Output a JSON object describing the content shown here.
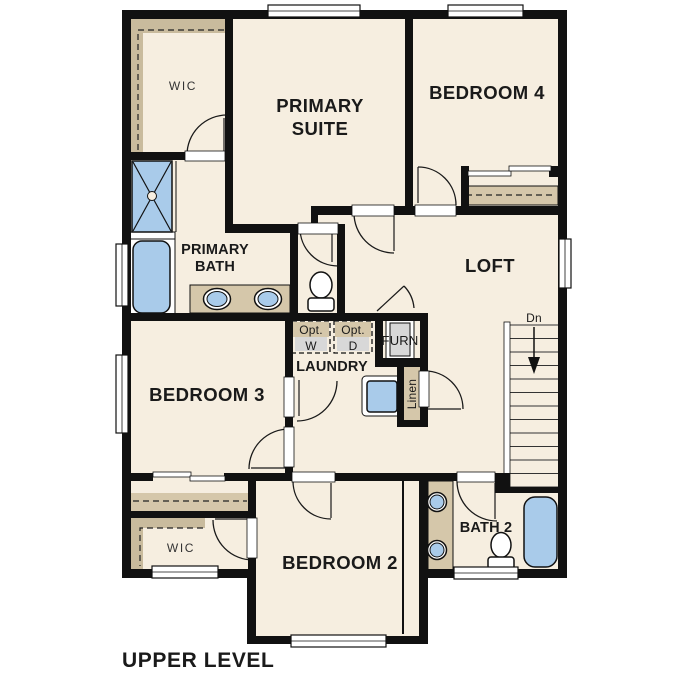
{
  "title": "UPPER LEVEL",
  "colors": {
    "floor": "#f6eee0",
    "tan": "#d5c7aa",
    "tan_dark": "#c9bb9d",
    "blue": "#a9cbea",
    "gray": "#d8d8d8",
    "wall": "#111111",
    "white": "#ffffff",
    "text": "#1a1a1a"
  },
  "rooms": {
    "primary_wic": {
      "label": "WIC"
    },
    "primary_suite": {
      "label_line1": "PRIMARY",
      "label_line2": "SUITE"
    },
    "bedroom_4": {
      "label": "BEDROOM 4"
    },
    "primary_bath": {
      "label_line1": "PRIMARY",
      "label_line2": "BATH"
    },
    "loft": {
      "label": "LOFT"
    },
    "bedroom_3": {
      "label": "BEDROOM 3"
    },
    "laundry": {
      "label": "LAUNDRY"
    },
    "bedroom_2": {
      "label": "BEDROOM 2"
    },
    "bath_2": {
      "label": "BATH 2"
    },
    "bedroom_2_wic": {
      "label": "WIC"
    }
  },
  "annotations": {
    "optional_washer": {
      "line1": "Opt.",
      "line2": "W"
    },
    "optional_dryer": {
      "line1": "Opt.",
      "line2": "D"
    },
    "furnace": {
      "label": "FURN"
    },
    "linen_closet": {
      "label": "Linen"
    },
    "stairs_direction": {
      "label": "Dn"
    }
  }
}
